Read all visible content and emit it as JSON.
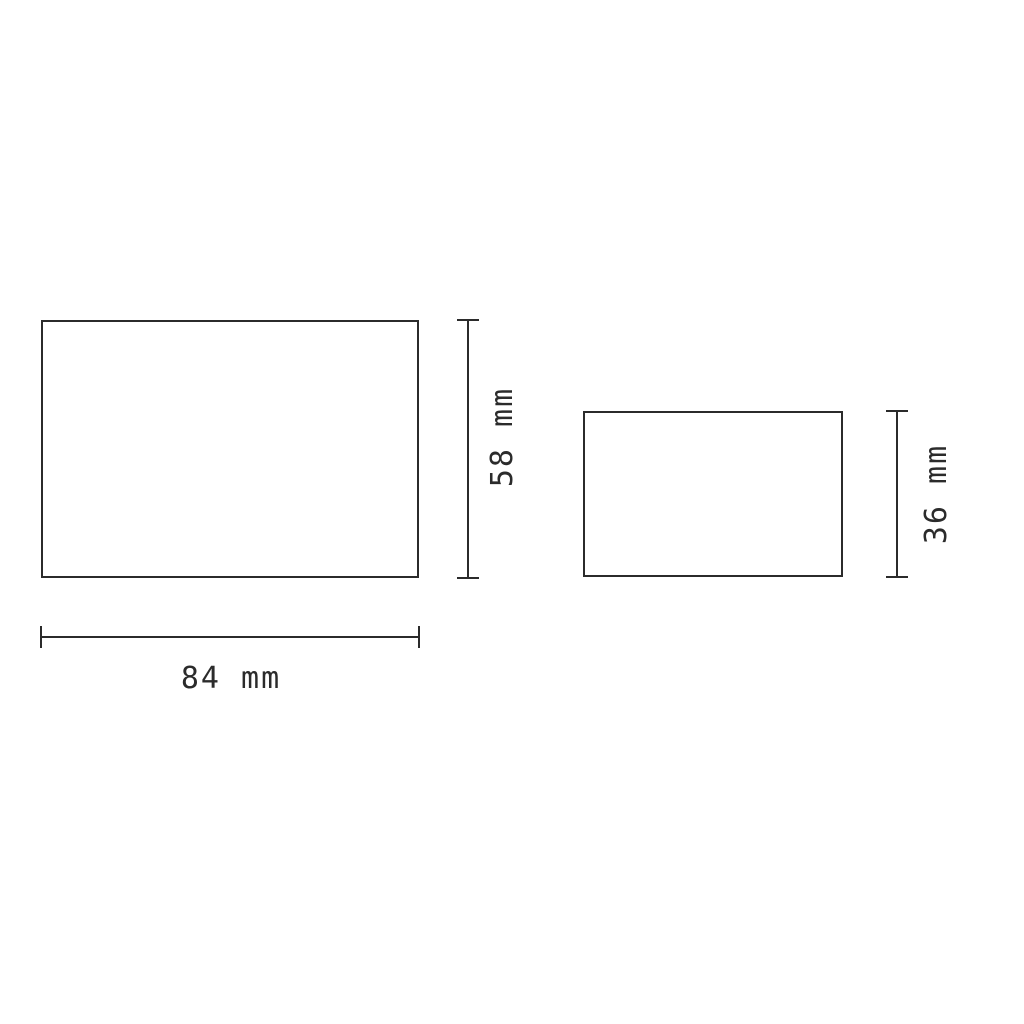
{
  "drawing": {
    "stroke_color": "#2b2b2b",
    "background_color": "#ffffff",
    "unit": "mm",
    "large_rect": {
      "width_label": "84 mm",
      "height_label": "58 mm",
      "width_value": 84,
      "height_value": 58
    },
    "small_rect": {
      "height_label": "36 mm",
      "height_value": 36
    }
  }
}
